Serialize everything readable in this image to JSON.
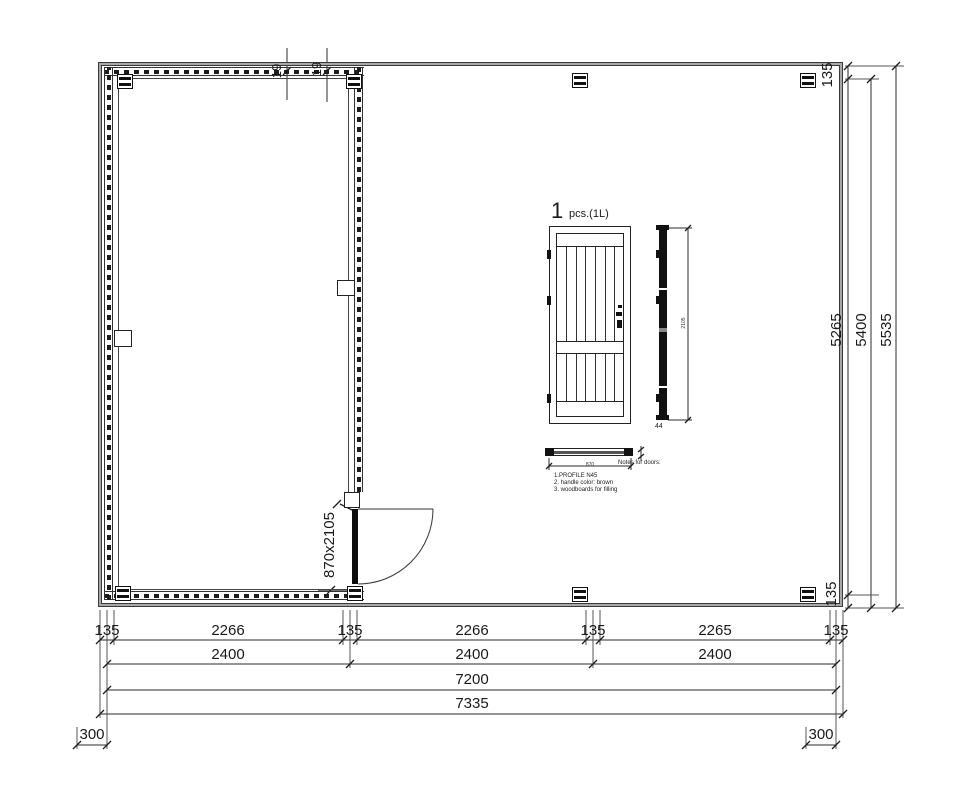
{
  "plan": {
    "door_size_label": "870x2105",
    "board_thickness_labels": [
      "19",
      "19"
    ]
  },
  "dimensions": {
    "bottom_row1": [
      "135",
      "2266",
      "135",
      "2266",
      "135",
      "2265",
      "135"
    ],
    "bottom_row2": [
      "2400",
      "2400",
      "2400"
    ],
    "bottom_row3": "7200",
    "bottom_row4": "7335",
    "overhang_left": "300",
    "overhang_right": "300",
    "right_top": "135",
    "right_inner": "5265",
    "right_middle": "5400",
    "right_outer": "5535",
    "right_bottom": "135"
  },
  "door_detail": {
    "quantity": "1",
    "quantity_note": "pcs.(1L)",
    "width_label": "870",
    "height_label": "2105",
    "thickness_label": "44",
    "notes_title": "Notes for doors:",
    "notes": [
      "1.PROFILE N45",
      "2. handle color: brown",
      "3. woodboards for filling"
    ]
  },
  "colors": {
    "line": "#2b2b2b",
    "boundary_gray": "#a8a8a8"
  }
}
